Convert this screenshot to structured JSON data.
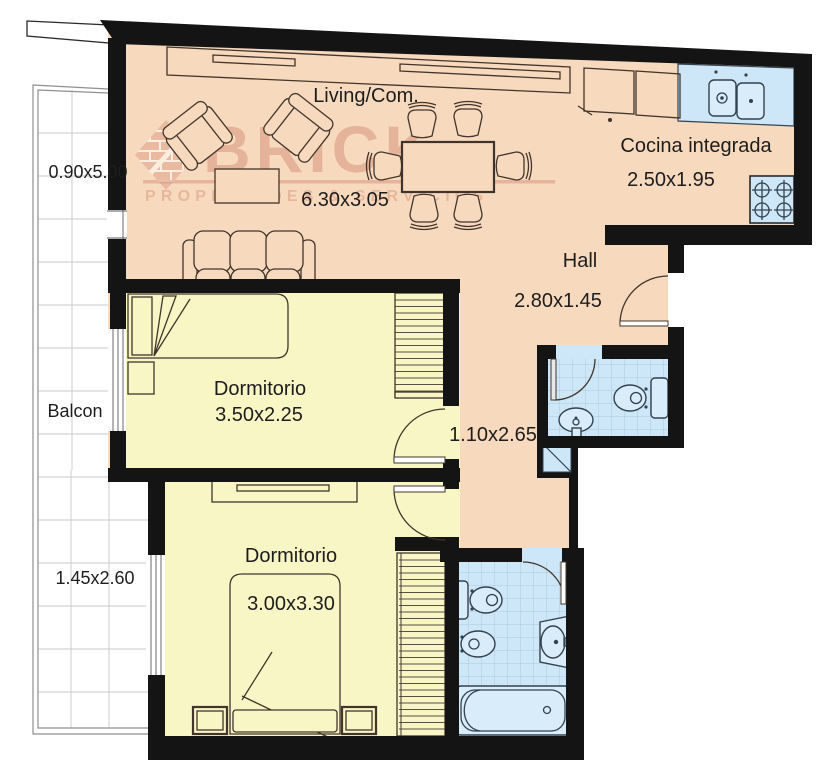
{
  "watermark": {
    "brand": "BRICK",
    "tagline": "PROPIEDADES & SERVICIOS"
  },
  "rooms": {
    "living": {
      "name": "Living/Com.",
      "dims": "6.30x3.05"
    },
    "kitchen": {
      "name": "Cocina integrada",
      "dims": "2.50x1.95"
    },
    "hall": {
      "name": "Hall",
      "dims": "2.80x1.45"
    },
    "corridor": {
      "dims": "1.10x2.65"
    },
    "bedroom1": {
      "name": "Dormitorio",
      "dims": "3.50x2.25"
    },
    "bedroom2": {
      "name": "Dormitorio",
      "dims": "3.00x3.30"
    },
    "balcony": {
      "name": "Balcon",
      "dims_upper": "0.90x5.00",
      "dims_lower": "1.45x2.60"
    }
  },
  "colors": {
    "floor_living": "#f7dabe",
    "floor_bedroom": "#f8f6c5",
    "floor_bath": "#cde7f8",
    "wall": "#141414",
    "watermark": "#cb7a63"
  }
}
